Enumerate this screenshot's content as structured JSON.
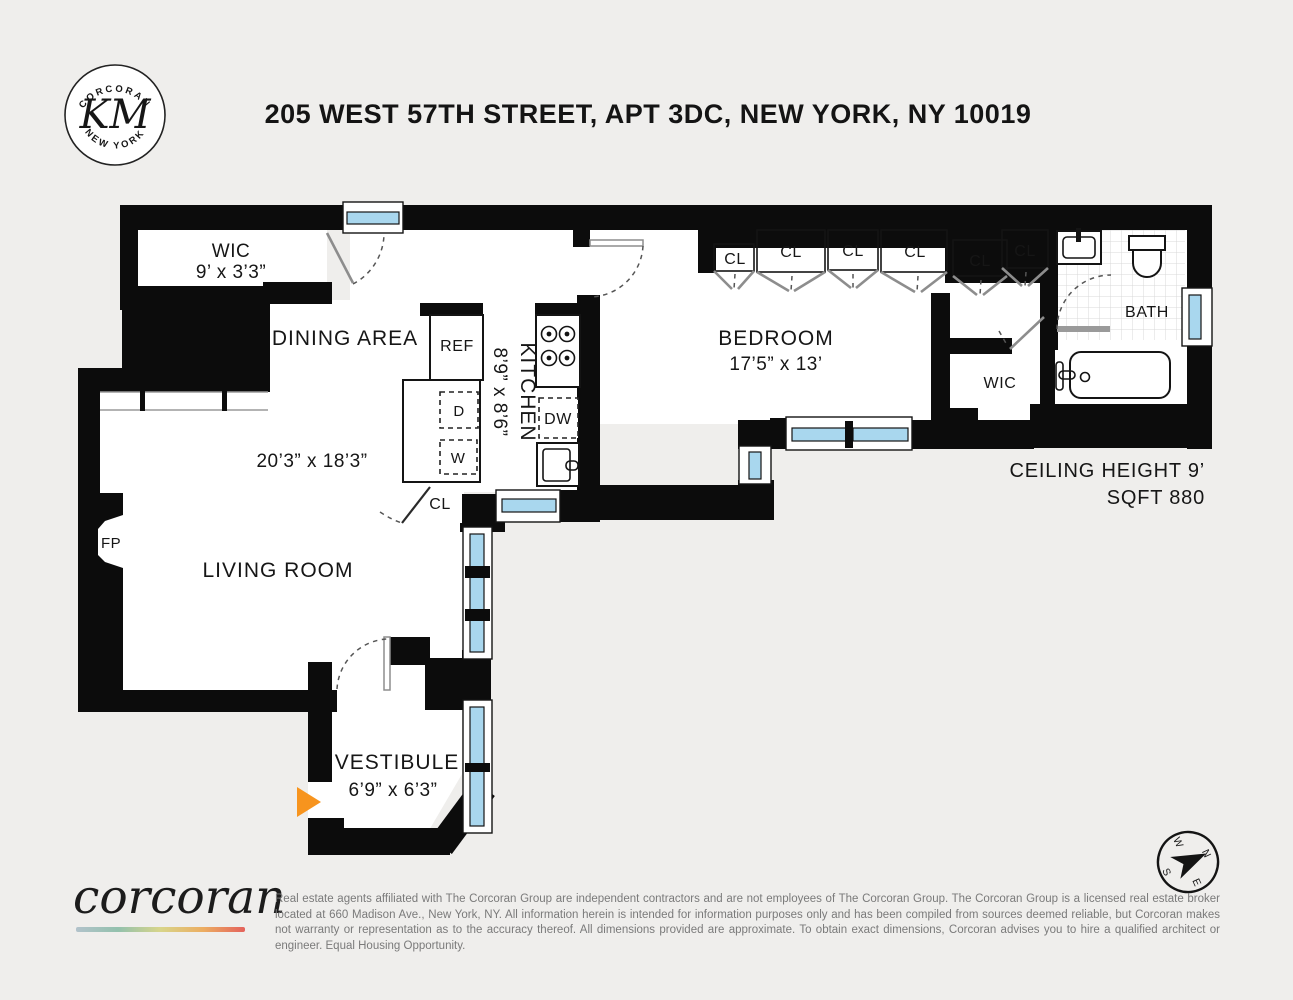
{
  "colors": {
    "background": "#efeeec",
    "wall": "#0c0c0c",
    "window_glass": "#a9d7ee",
    "entry_arrow": "#f7941e"
  },
  "header": {
    "title": "205 WEST 57TH STREET, APT 3DC, NEW YORK, NY 10019",
    "logo": {
      "top_arc": "CORCORAN",
      "monogram": "KM",
      "bottom_arc": "NEW YORK"
    }
  },
  "plan": {
    "wic1": {
      "name": "WIC",
      "dims": "9’ x 3’3”"
    },
    "dining": {
      "name": "DINING AREA"
    },
    "living": {
      "name": "LIVING ROOM",
      "dims": "20’3” x 18’3”"
    },
    "kitchen": {
      "name": "KITCHEN",
      "dims": "8’9” x 8’6”"
    },
    "bedroom": {
      "name": "BEDROOM",
      "dims": "17’5” x 13’"
    },
    "bath": {
      "name": "BATH"
    },
    "wic2": {
      "name": "WIC"
    },
    "vestibule": {
      "name": "VESTIBULE",
      "dims": "6’9” x 6’3”"
    },
    "fireplace": "FP",
    "closet": "CL",
    "appliances": {
      "ref": "REF",
      "dishwasher": "DW",
      "dryer": "D",
      "washer": "W"
    },
    "notes": {
      "ceiling": "CEILING HEIGHT 9’",
      "sqft": "SQFT 880"
    },
    "compass": {
      "n": "N",
      "e": "E",
      "s": "S",
      "w": "W"
    }
  },
  "footer": {
    "brand": "corcoran",
    "disclaimer": "Real estate agents affiliated with The Corcoran Group are independent contractors and are not employees of The Corcoran Group. The Corcoran Group is a licensed real estate broker located at 660 Madison Ave., New York, NY. All information herein is intended for information purposes only and has been compiled from sources deemed reliable, but Corcoran makes not warranty or representation as to the accuracy thereof. All dimensions provided are approximate. To obtain exact dimensions, Corcoran advises you to hire a qualified architect or engineer. Equal Housing Opportunity."
  }
}
